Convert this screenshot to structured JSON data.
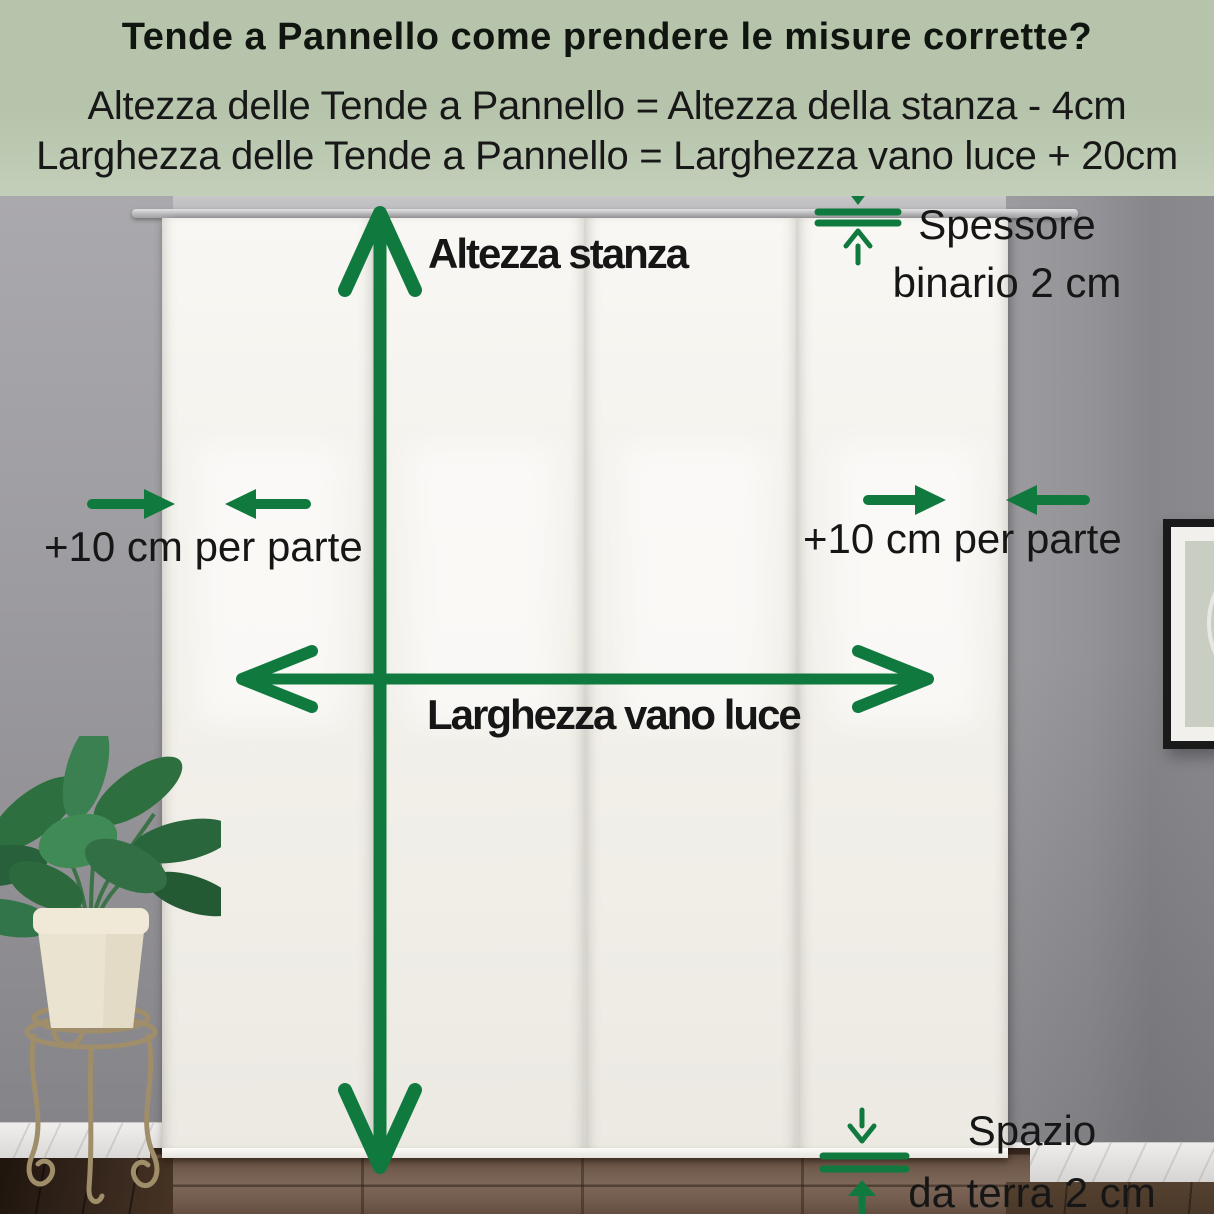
{
  "header": {
    "title": "Tende a Pannello come prendere le misure corrette?",
    "formula_height": "Altezza delle Tende a Pannello = Altezza della stanza - 4cm",
    "formula_width": "Larghezza delle Tende a Pannello = Larghezza vano luce + 20cm"
  },
  "annotations": {
    "room_height": "Altezza stanza",
    "opening_width": "Larghezza vano luce",
    "side_allowance_left": "+10 cm per parte",
    "side_allowance_right": "+10 cm per parte",
    "track_thickness": {
      "line1": "Spessore",
      "line2": "binario 2 cm"
    },
    "floor_gap": {
      "line1": "Spazio",
      "line2": "da terra 2 cm"
    }
  },
  "colors": {
    "accent_green": "#107a3e",
    "header_bg": "#b6c4ab",
    "header_bg_light": "#c3cfb9",
    "text_dark": "#161616"
  }
}
